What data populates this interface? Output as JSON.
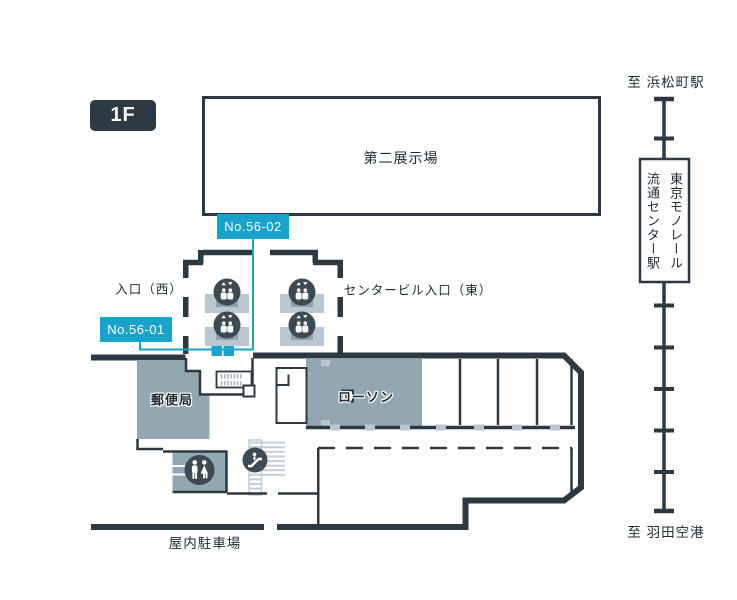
{
  "floor": {
    "badge": "1F"
  },
  "map": {
    "exhibition_hall": "第二展示場",
    "entrance_west": "入口（西）",
    "entrance_east": "センタービル入口（東）",
    "post_office": "郵便局",
    "lawson": "ローソン",
    "indoor_parking": "屋内駐車場",
    "booth_labels": {
      "no_56_02": "No.56-02",
      "no_56_01": "No.56-01"
    }
  },
  "monorail": {
    "to_hamamatsucho": "至 浜松町駅",
    "to_haneda": "至 羽田空港",
    "station_name_line1": "東京モノレール",
    "station_name_line2": "流通センター駅"
  },
  "colors": {
    "accent_cyan": "#18a4ca",
    "wall_dark": "#2c3942",
    "room_gray": "#93a7b3",
    "unit_light": "#b9c7d1",
    "unit_mid": "#8da1ac",
    "icon_circle": "#3e4a53",
    "stripe_light": "#c3ced6",
    "text_dark": "#1d2b33"
  },
  "icons": [
    {
      "name": "elevator-icon",
      "meaning": "elevator"
    },
    {
      "name": "restroom-icon",
      "meaning": "restroom"
    },
    {
      "name": "escalator-icon",
      "meaning": "escalator"
    },
    {
      "name": "stairs-hatch",
      "meaning": "stairs"
    }
  ]
}
